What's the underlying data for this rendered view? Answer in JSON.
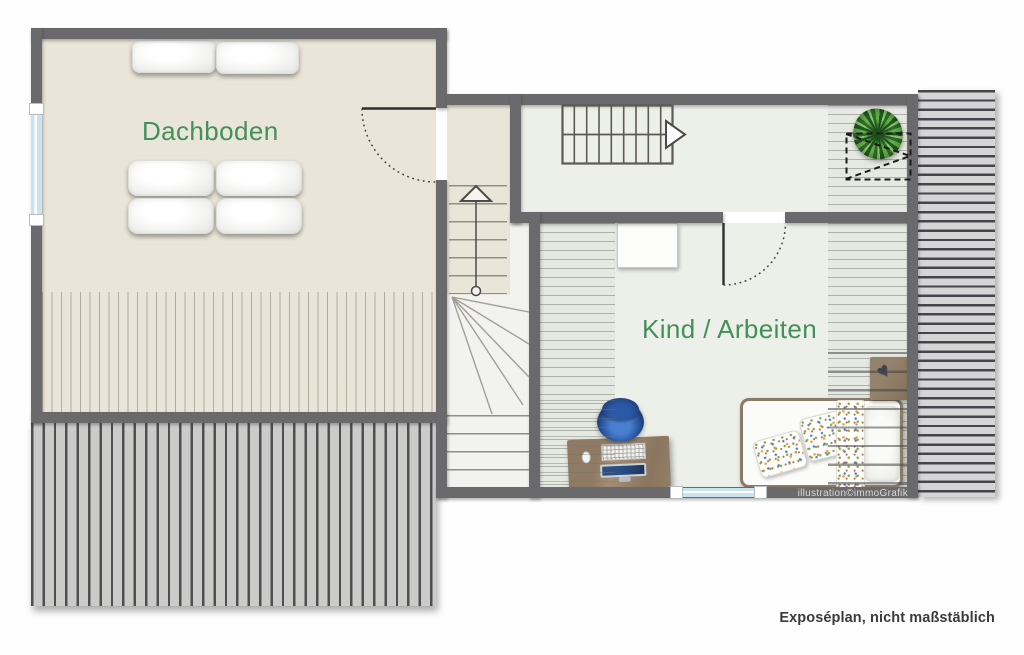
{
  "plan": {
    "rooms": [
      {
        "id": "dachboden",
        "label": "Dachboden"
      },
      {
        "id": "kind-arbeiten",
        "label": "Kind / Arbeiten"
      }
    ],
    "watermark": "illustration©immoGrafik",
    "footnote": "Exposéplan, nicht maßstäblich",
    "decor": {
      "heart_glyph": "♥"
    },
    "features": [
      "staircase-upper-flight",
      "staircase-lower-flight-with-winders",
      "door-dachboden",
      "door-kind-arbeiten",
      "window-left-wall",
      "window-bottom-wall",
      "roof-window-dashed-symbol",
      "potted-plant",
      "sloped-roof-hatching-left",
      "sloped-roof-hatching-right"
    ],
    "furniture": {
      "dachboden": [
        "mattress-pair-top",
        "sofa-mattress-2x2"
      ],
      "kind_arbeiten": [
        "wardrobe",
        "desk",
        "office-chair",
        "keyboard",
        "mouse",
        "monitor",
        "single-bed",
        "spotted-pillows",
        "spotted-blanket",
        "head-pillow",
        "wall-shelf"
      ]
    },
    "colors": {
      "wall": "#6a6a6d",
      "floor_attic": "#e9e5d8",
      "floor_room": "#edefe9",
      "hatch_bg": "#e6e8e2",
      "roof_band_bottom": "#cbcbc9",
      "roof_band_right": "#d5d5d5",
      "label_green": "#44905a",
      "window_blue": "#c9e4f0",
      "wood": "#8f7b65",
      "chair_blue": "#2c5ba8"
    }
  }
}
